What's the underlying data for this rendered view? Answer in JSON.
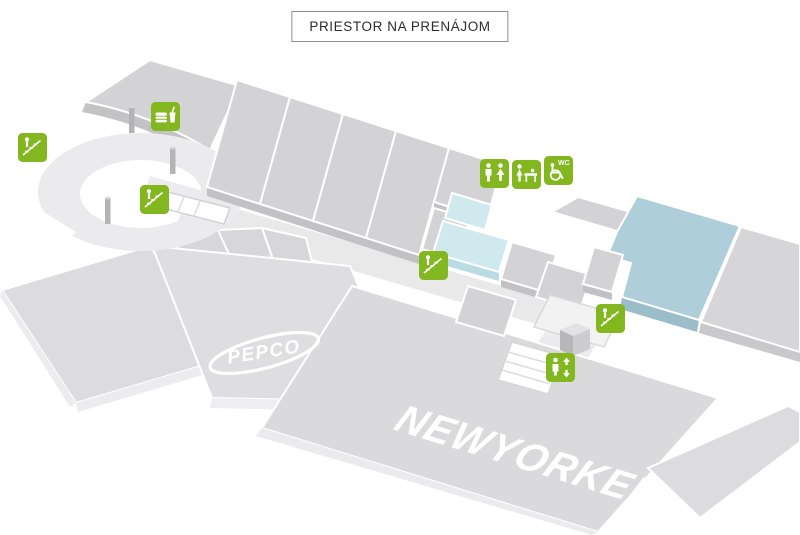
{
  "title": {
    "label": "PRIESTOR NA PRENÁJOM"
  },
  "colors": {
    "icon_green": "#82b71f",
    "highlight_blue": "#aeceda",
    "highlight_blue_side": "#9bbdca",
    "highlight_cyan": "#cfe9ef",
    "highlight_cyan_side": "#b8dbe4",
    "logo_white": "#ffffff"
  },
  "map": {
    "logos": {
      "pepco": "PEPCO",
      "new_yorker": "NEWYORKER"
    },
    "accessible_wc_label": "WC",
    "icons": [
      {
        "name": "escalator-icon-1",
        "type": "escalator"
      },
      {
        "name": "food-court-icon",
        "type": "food"
      },
      {
        "name": "escalator-icon-2",
        "type": "escalator"
      },
      {
        "name": "wc-icon",
        "type": "toilets"
      },
      {
        "name": "baby-changing-icon",
        "type": "baby-changing"
      },
      {
        "name": "accessible-wc-icon",
        "type": "accessible-wc",
        "label": "WC"
      },
      {
        "name": "escalator-icon-3",
        "type": "escalator"
      },
      {
        "name": "escalator-icon-4",
        "type": "escalator"
      },
      {
        "name": "elevator-icon",
        "type": "elevator"
      }
    ]
  }
}
